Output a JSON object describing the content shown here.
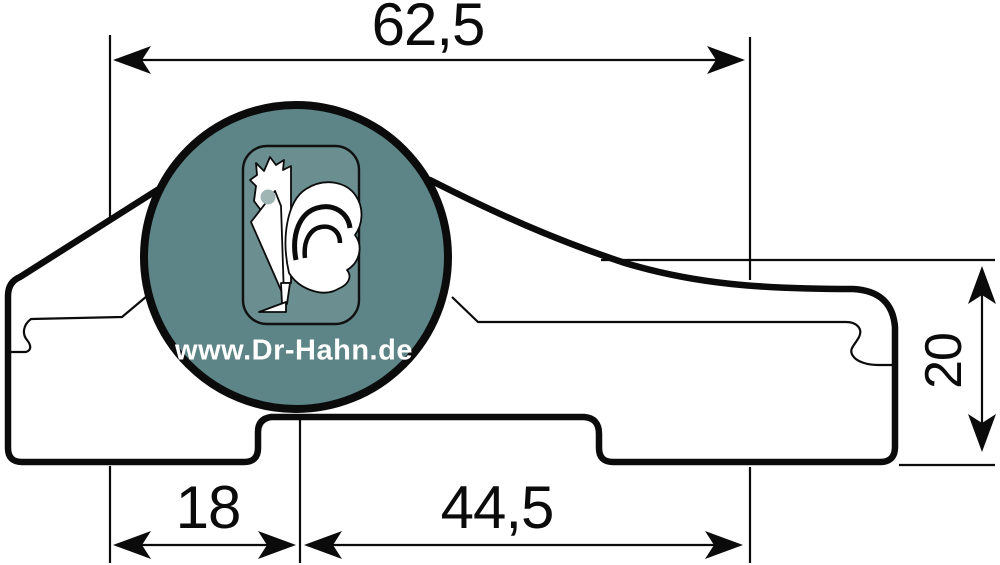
{
  "drawing": {
    "type": "technical-dimension-drawing",
    "subject": "door hinge profile cross-section",
    "dimensions": {
      "width_top": "62,5",
      "height_right": "20",
      "offset_bottom_left": "18",
      "width_bottom_center": "44,5"
    },
    "logo": {
      "url": "www.Dr-Hahn.de",
      "icon": "rooster-icon"
    },
    "colors": {
      "line": "#0b0b0b",
      "background": "#ffffff",
      "logo_circle": "#5d8486",
      "logo_panel": "#6b8e90",
      "logo_eye": "#9fb5b4",
      "logo_text": "#ffffff"
    }
  }
}
